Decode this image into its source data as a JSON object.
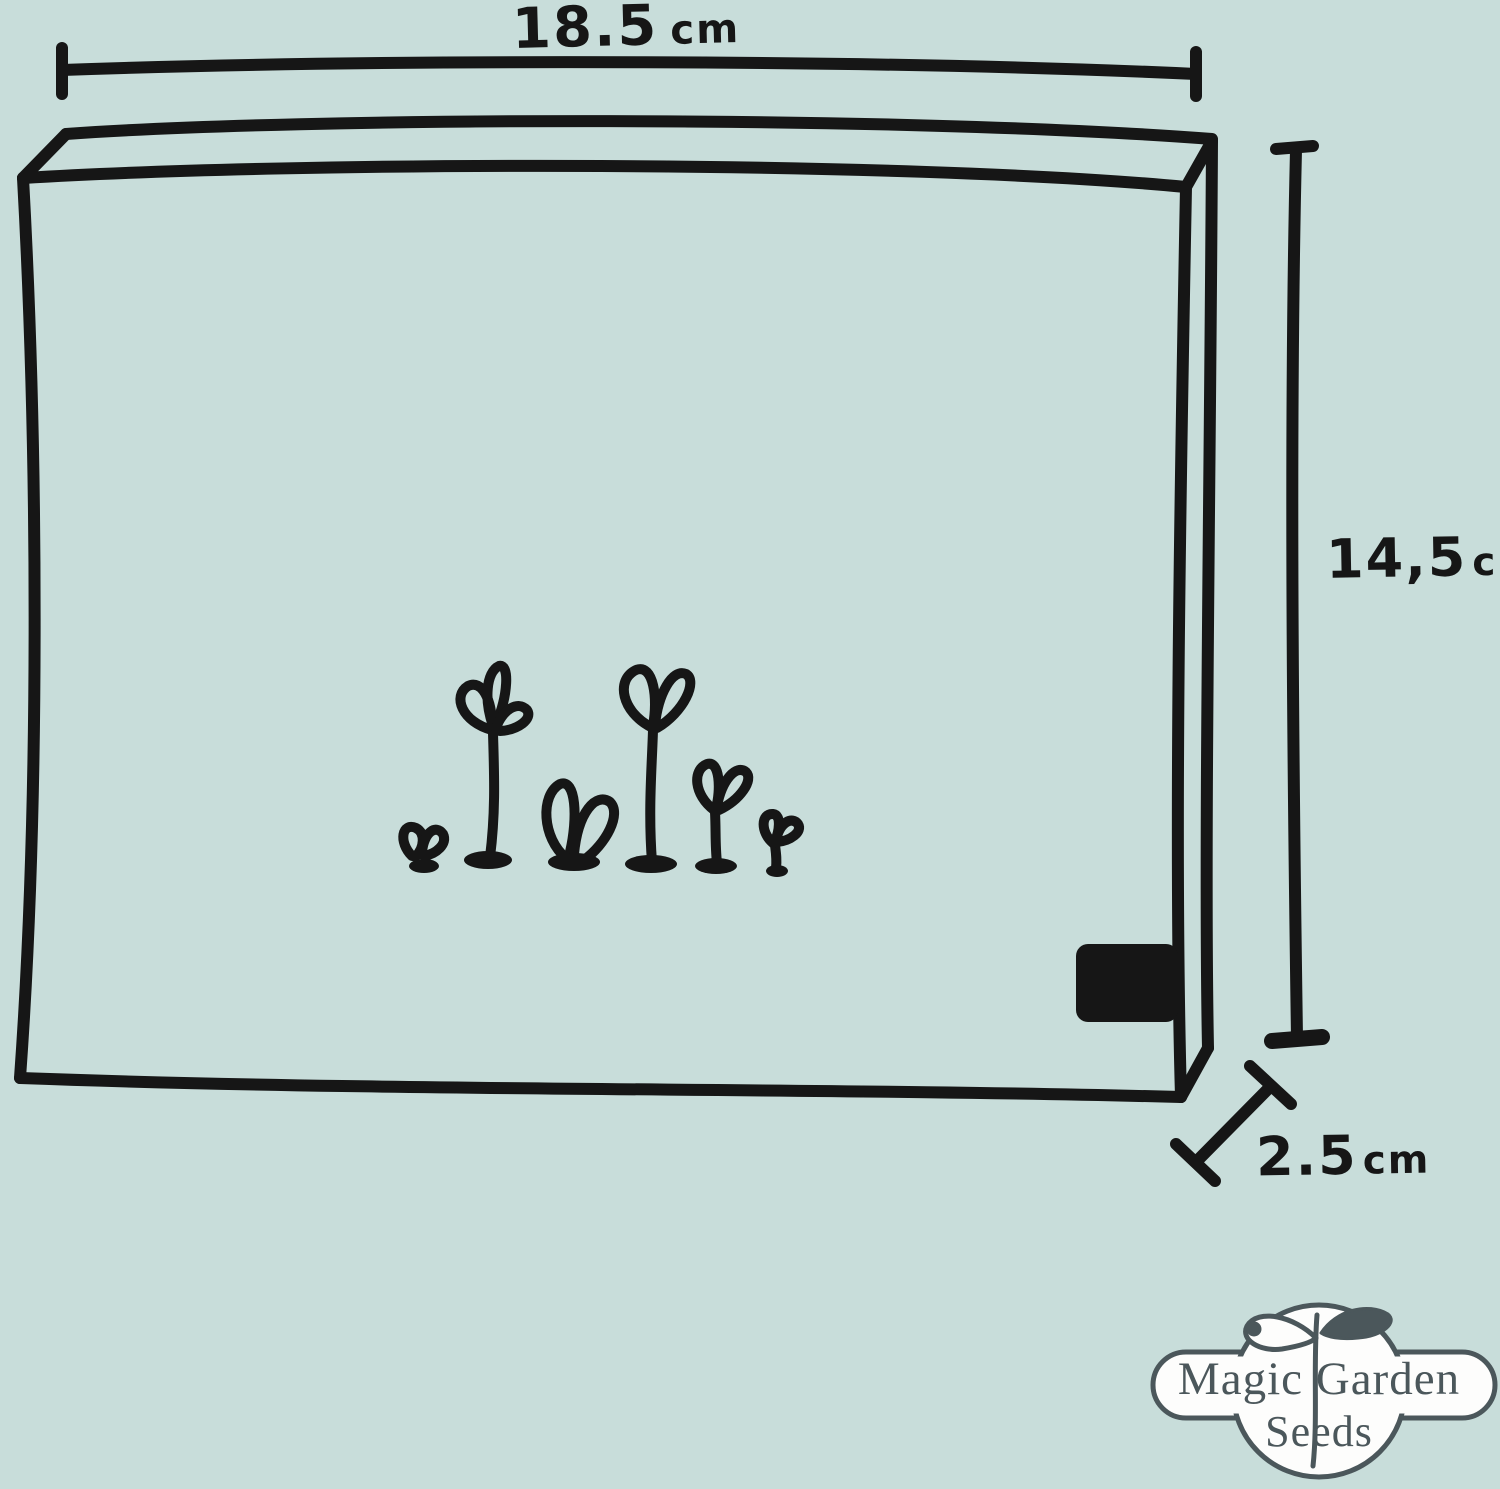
{
  "dimensions": {
    "width": {
      "value": "18.5",
      "unit": "cm"
    },
    "height": {
      "value": "14,5",
      "unit": "cm"
    },
    "depth": {
      "value": "2.5",
      "unit": "cm"
    }
  },
  "logo": {
    "line1": "Magic Garden",
    "line2": "Seeds"
  },
  "colors": {
    "background": "#c8ddda",
    "ink": "#161616",
    "logo": "#4b575b",
    "logo_fill": "#fdfdfc"
  },
  "icons": {
    "illustration": "seedling-sprouts-icon",
    "logo_mark": "sprout-icon"
  }
}
